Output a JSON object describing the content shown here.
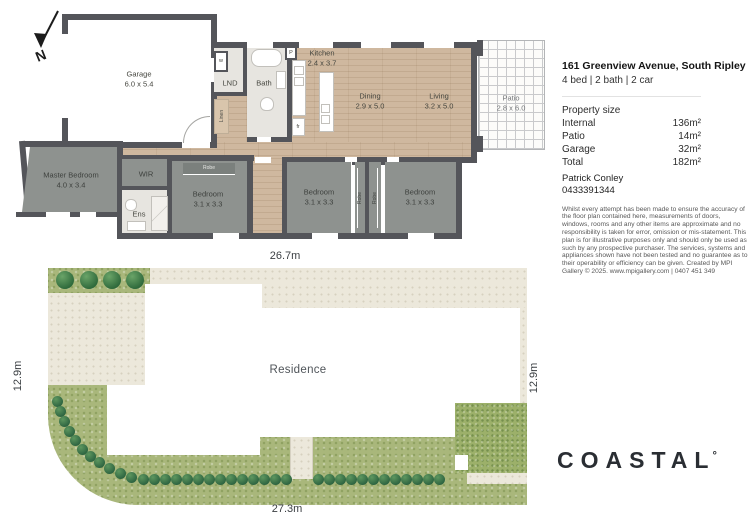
{
  "listing": {
    "address": "161 Greenview Avenue, South Ripley",
    "summary": "4 bed | 2 bath | 2 car"
  },
  "property_size": {
    "title": "Property size",
    "rows": [
      {
        "label": "Internal",
        "value": "136m²"
      },
      {
        "label": "Patio",
        "value": "14m²"
      },
      {
        "label": "Garage",
        "value": "32m²"
      },
      {
        "label": "Total",
        "value": "182m²"
      }
    ]
  },
  "agent": {
    "name": "Patrick Conley",
    "phone": "0433391344"
  },
  "disclaimer": "Whilst every attempt has been made to ensure the accuracy of the floor plan contained here, measurements of doors, windows, rooms and any other items are approximate and no responsibility is taken for error, omission or mis-statement. This plan is for illustrative purposes only and should only be used as such by any prospective purchaser. The services, systems and appliances shown have not been tested and no guarantee as to their operability or efficiency can be given. Created by MPI Gallery © 2025. www.mpigallery.com | 0407 451 349",
  "brand": {
    "name": "COASTAL",
    "degree": "°"
  },
  "floor_plan": {
    "north_label": "N",
    "rooms": [
      {
        "name": "Garage",
        "dims": "6.0 x 5.4"
      },
      {
        "name": "Kitchen",
        "dims": "2.4 x 3.7"
      },
      {
        "name": "Dining",
        "dims": "2.9 x 5.0"
      },
      {
        "name": "Living",
        "dims": "3.2 x 5.0"
      },
      {
        "name": "Patio",
        "dims": "2.8 x 6.0"
      },
      {
        "name": "Master Bedroom",
        "dims": "4.0 x 3.4"
      },
      {
        "name": "Bedroom",
        "dims": "3.1 x 3.3"
      },
      {
        "name": "Bedroom",
        "dims": "3.1 x 3.3"
      },
      {
        "name": "Bedroom",
        "dims": "3.1 x 3.3"
      }
    ],
    "labels": {
      "lnd": "LND",
      "bath": "Bath",
      "wir": "WIR",
      "ens": "Ens",
      "linen": "Linen",
      "robe": "Robe",
      "washer": "w",
      "pantry": "P",
      "fridge": "fr"
    }
  },
  "site_plan": {
    "residence_label": "Residence",
    "dim_top": "26.7m",
    "dim_bottom": "27.3m",
    "dim_left": "12.9m",
    "dim_right": "12.9m"
  },
  "colors": {
    "wall": "#54555a",
    "wood_floor": "#cfb89f",
    "bedroom_fill": "#8e928f",
    "site_green": "#a9b77b",
    "paving_beige": "#ece8db",
    "brand_text": "#2a2e33"
  }
}
